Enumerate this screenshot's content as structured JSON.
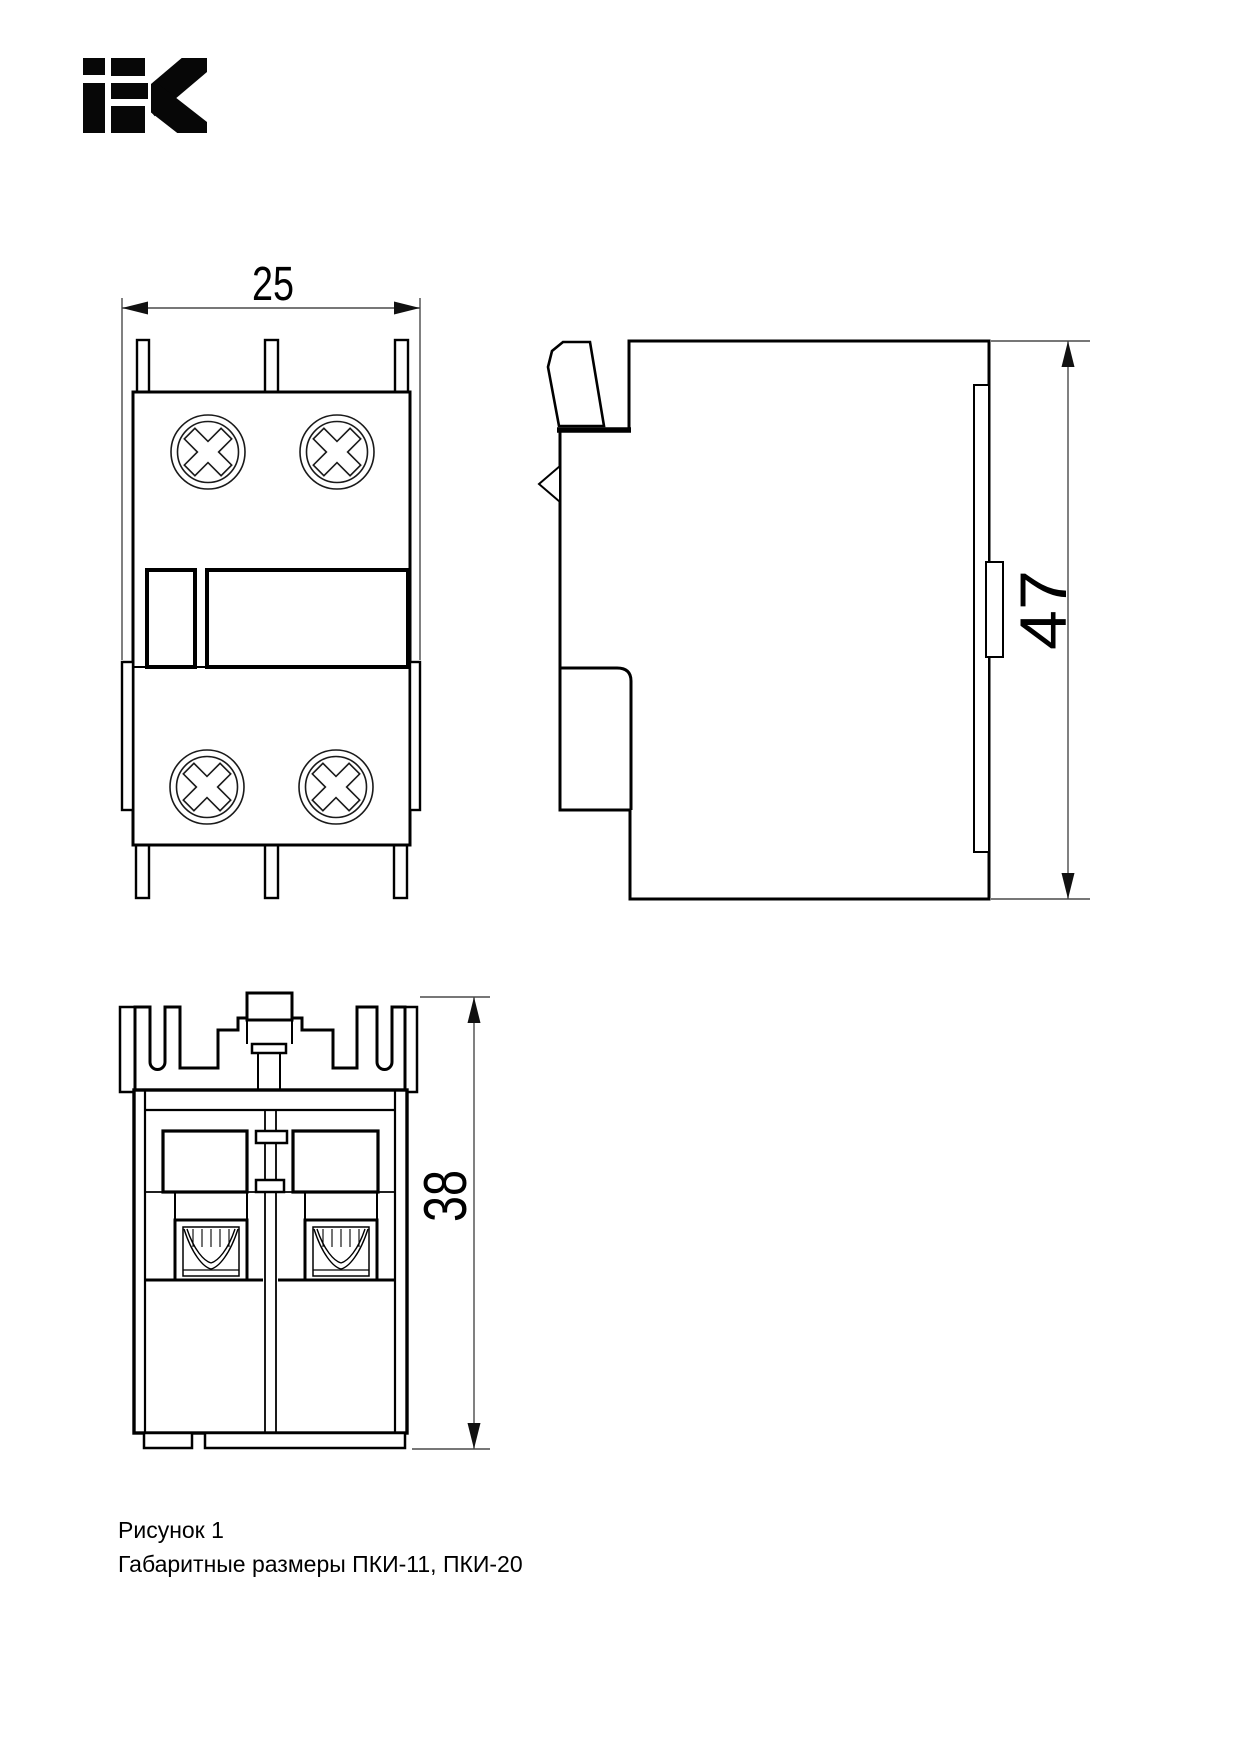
{
  "colors": {
    "background": "#ffffff",
    "line": "#000000",
    "dim_line": "#4a4a4a"
  },
  "logo": {
    "label": "IEK"
  },
  "drawing": {
    "dimensions": {
      "front_width": "25",
      "side_height": "47",
      "bottom_height": "38"
    },
    "caption": {
      "line1": "Рисунок 1",
      "line2": "Габаритные размеры ПКИ-11, ПКИ-20"
    }
  }
}
